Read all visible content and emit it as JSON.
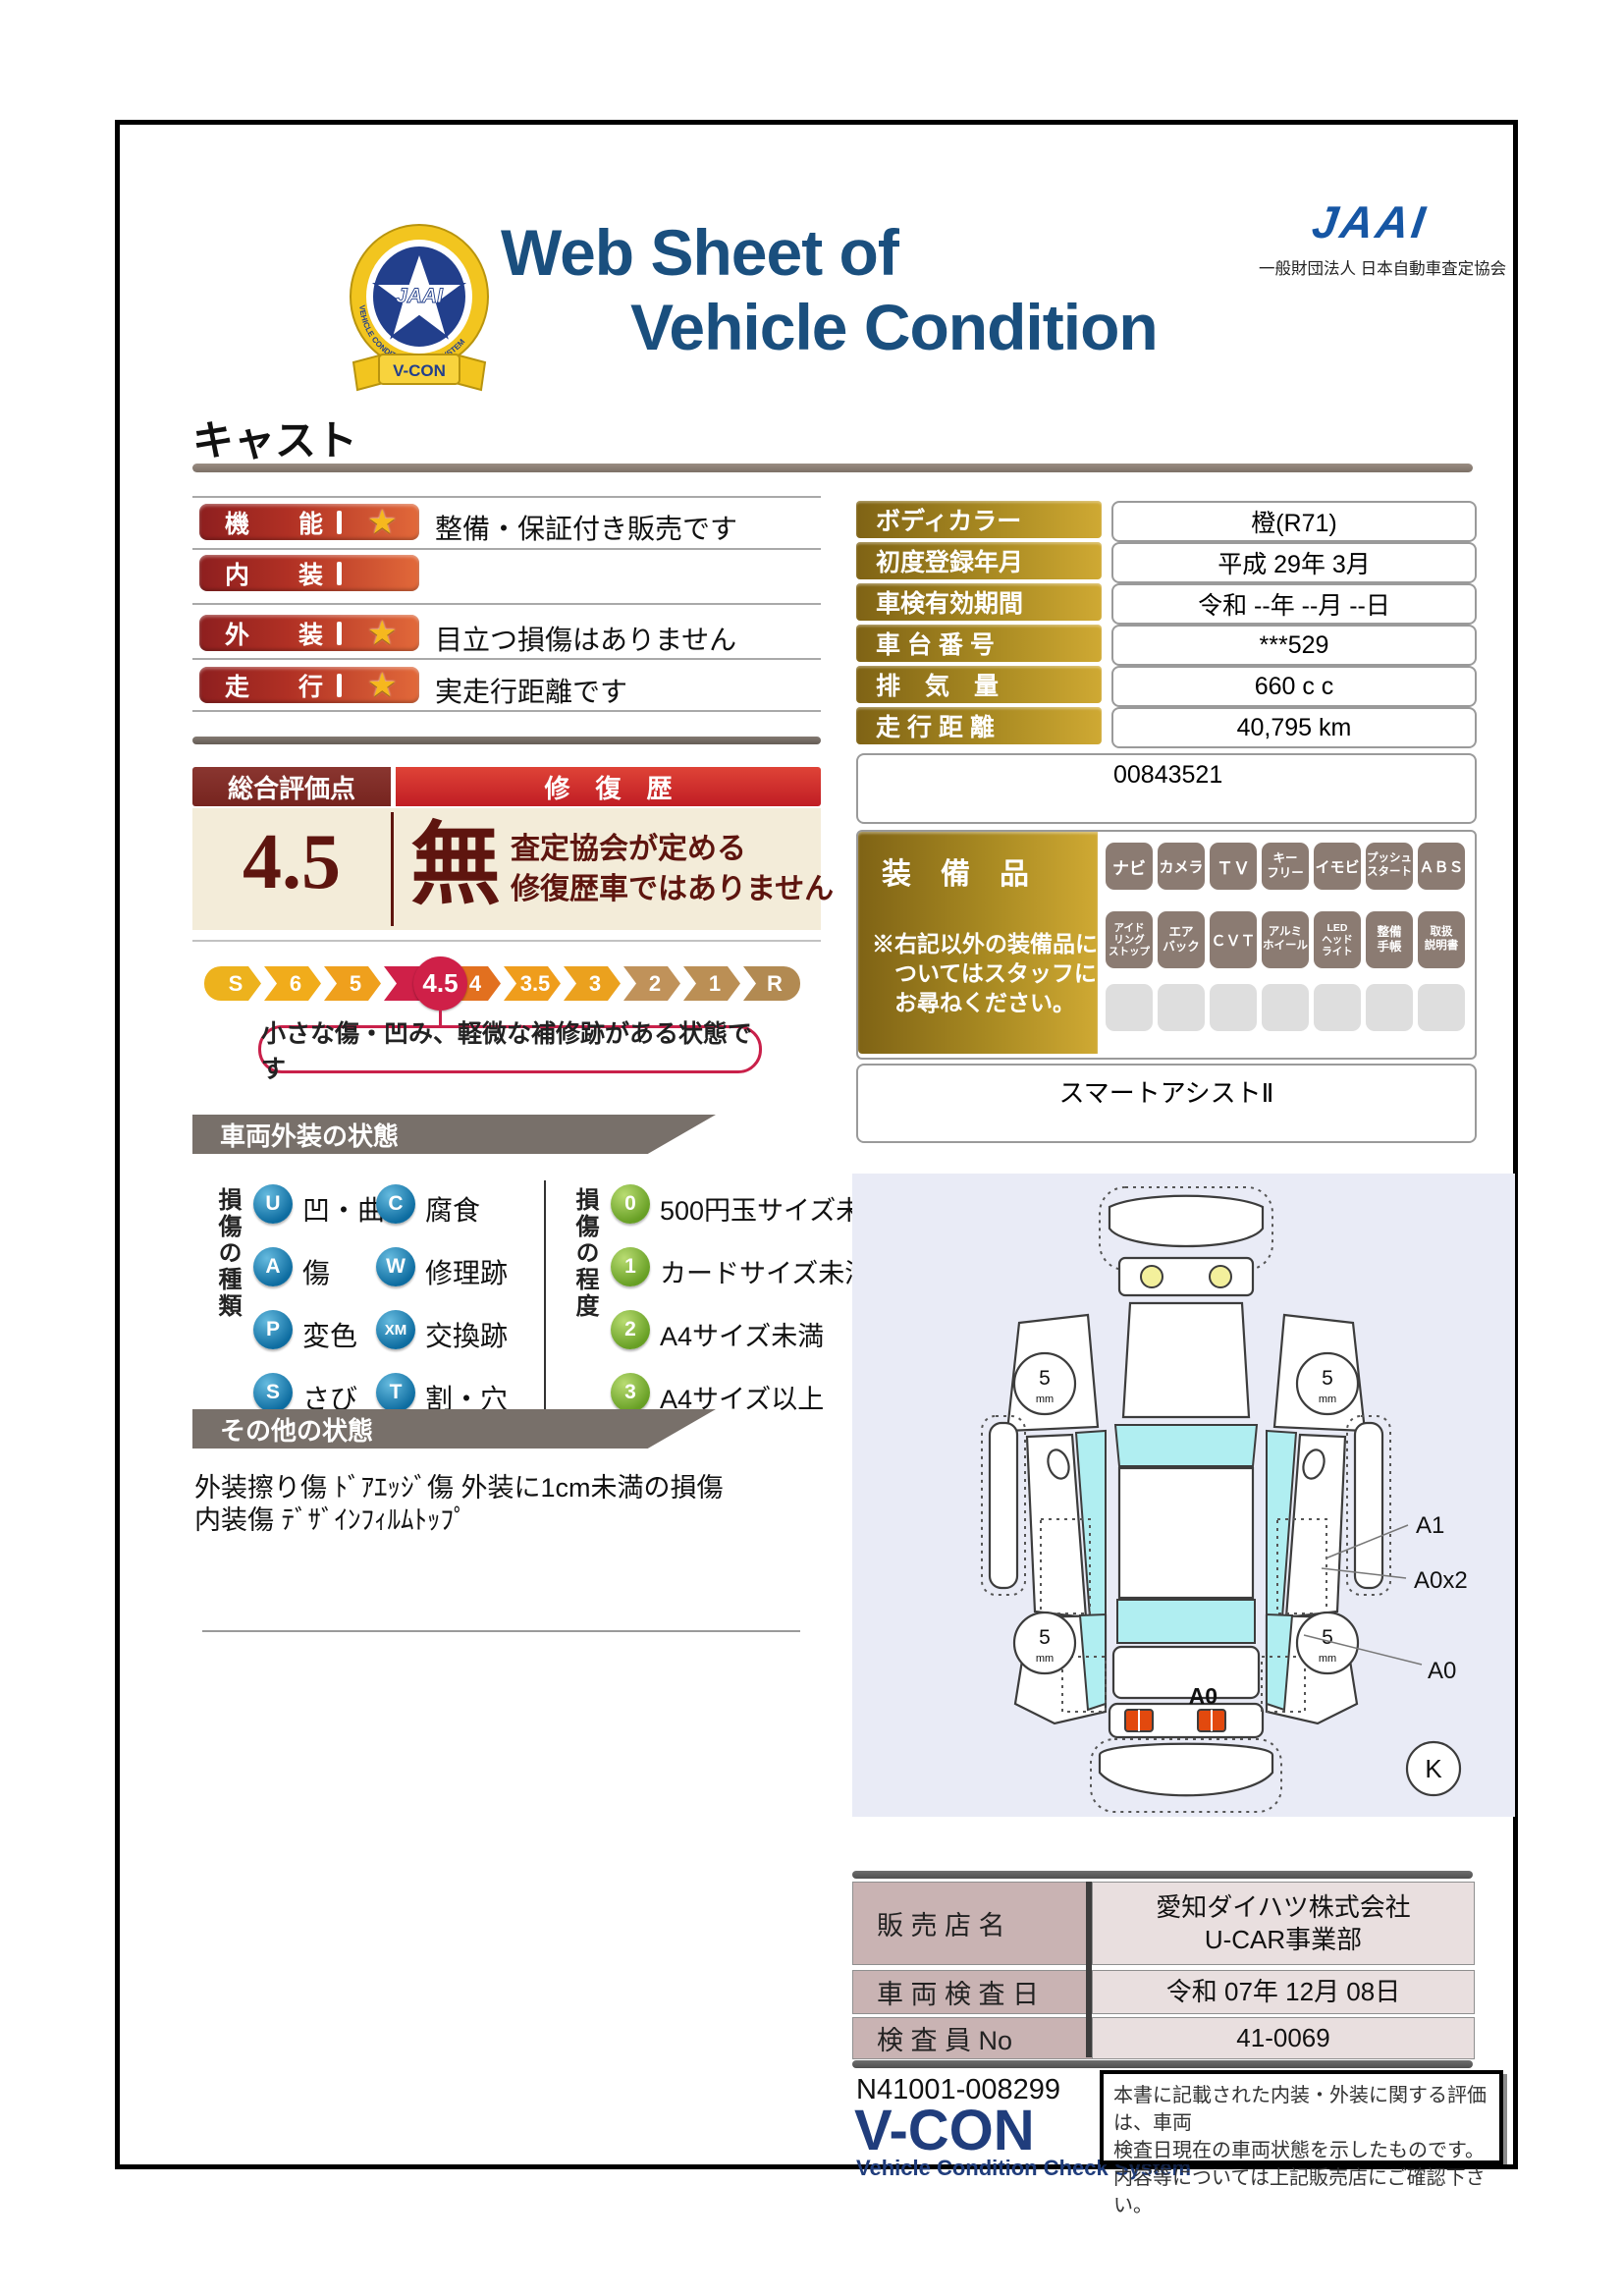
{
  "header": {
    "title_line1": "Web Sheet of",
    "title_line2": "Vehicle Condition",
    "jaai_wordmark": "JAAI",
    "jaai_subtitle": "一般財団法人 日本自動車査定協会",
    "emblem_center": "JAAI",
    "emblem_ribbon": "V-CON",
    "emblem_ring_text": "VEHICLE CONDITION CHECK SYSTEM"
  },
  "vehicle_name": "キャスト",
  "ratings": {
    "star": "★",
    "rows": [
      {
        "label": "機　　能",
        "note": "整備・保証付き販売です"
      },
      {
        "label": "内　　装",
        "note": ""
      },
      {
        "label": "外　　装",
        "note": "目立つ損傷はありません"
      },
      {
        "label": "走　　行",
        "note": "実走行距離です"
      }
    ]
  },
  "info": {
    "rows": [
      {
        "label": "ボディカラー",
        "value": "橙(R71)"
      },
      {
        "label": "初度登録年月",
        "value": "平成 29年 3月"
      },
      {
        "label": "車検有効期間",
        "value": "令和 --年 --月 --日"
      },
      {
        "label": "車 台 番 号",
        "value": "***529"
      },
      {
        "label": "排　気　量",
        "value": "660 c c"
      },
      {
        "label": "走 行 距 離",
        "value": "40,795 km"
      }
    ],
    "reference_number": "00843521"
  },
  "overall": {
    "header_left": "総合評価点",
    "header_right": "修　復　歴",
    "score": "4.5",
    "repair": "無",
    "repair_note": "査定協会が定める\n修復歴車ではありません",
    "scale": [
      "S",
      "6",
      "5",
      "4.5",
      "4",
      "3.5",
      "3",
      "2",
      "1",
      "R"
    ],
    "selected_score": "4.5",
    "scale_note": "小さな傷・凹み、軽微な補修跡がある状態です"
  },
  "equipment": {
    "title": "装　備　品",
    "note": "※右記以外の装備品に\n　ついてはスタッフに\n　お尋ねください。",
    "installed": [
      "ナビ",
      "カメラ",
      "ＴＶ",
      "キー\nフリー",
      "イモビ",
      "プッシュ\nスタート",
      "ＡＢＳ",
      "アイド\nリング\nストップ",
      "エア\nバック",
      "ＣＶＴ",
      "アルミ\nホイール",
      "LED\nヘッド\nライト",
      "整備\n手帳",
      "取扱\n説明書"
    ],
    "extra": "スマートアシストⅡ"
  },
  "sections": {
    "exterior": "車両外装の状態",
    "other": "その他の状態"
  },
  "damage_legend": {
    "type_title": "損傷の種類",
    "types": [
      {
        "code": "U",
        "label": "凹・曲"
      },
      {
        "code": "A",
        "label": "傷"
      },
      {
        "code": "P",
        "label": "変色"
      },
      {
        "code": "S",
        "label": "さび"
      },
      {
        "code": "C",
        "label": "腐食"
      },
      {
        "code": "W",
        "label": "修理跡"
      },
      {
        "code": "XM",
        "label": "交換跡"
      },
      {
        "code": "T",
        "label": "割・穴"
      }
    ],
    "degree_title": "損傷の程度",
    "degrees": [
      {
        "code": "0",
        "label": "500円玉サイズ未満"
      },
      {
        "code": "1",
        "label": "カードサイズ未満"
      },
      {
        "code": "2",
        "label": "A4サイズ未満"
      },
      {
        "code": "3",
        "label": "A4サイズ以上"
      }
    ]
  },
  "other_state_text": "外装擦り傷 ﾄﾞｱｴｯｼﾞ傷 外装に1cm未満の損傷\n内装傷 ﾃﾞｻﾞｲﾝﾌｨﾙﾑﾄｯﾌﾟ",
  "diagram": {
    "tread": "5",
    "tread_unit": "mm",
    "label_a1": "A1",
    "label_a0x2": "A0x2",
    "label_a0_side": "A0",
    "label_a0_rear": "A0",
    "grade_mark": "K"
  },
  "dealer": {
    "rows": [
      {
        "label": "販 売 店 名",
        "value": "愛知ダイハツ株式会社\nU-CAR事業部"
      },
      {
        "label": "車 両 検 査 日",
        "value": "令和 07年 12月 08日"
      },
      {
        "label": "検 査 員 No",
        "value": "41-0069"
      }
    ]
  },
  "footer": {
    "serial": "N41001-008299",
    "vcon": "V-CON",
    "vcon_sub": "Vehicle Condition Check System",
    "note": "本書に記載された内装・外装に関する評価は、車両\n検査日現在の車両状態を示したものです。\n内容等については上記販売店にご確認下さい。"
  },
  "colors": {
    "title_navy": "#1a4f7e",
    "jaai_blue": "#1656a4",
    "rating_red_dark": "#8e1f1f",
    "rating_orange": "#e2693a",
    "gold_dark": "#7f6315",
    "gold_light": "#cfa933",
    "repair_red": "#c01d24",
    "accent_crimson": "#cf2048",
    "beige": "#f3ecd9",
    "badge_gray": "#8b7b72",
    "tab_gray": "#78706a",
    "dealer_label_pink": "#c9b3b3",
    "dealer_value_pink": "#e9dfdf",
    "diagram_bg": "#e9ebf6",
    "window_cyan": "#b0eef1"
  }
}
